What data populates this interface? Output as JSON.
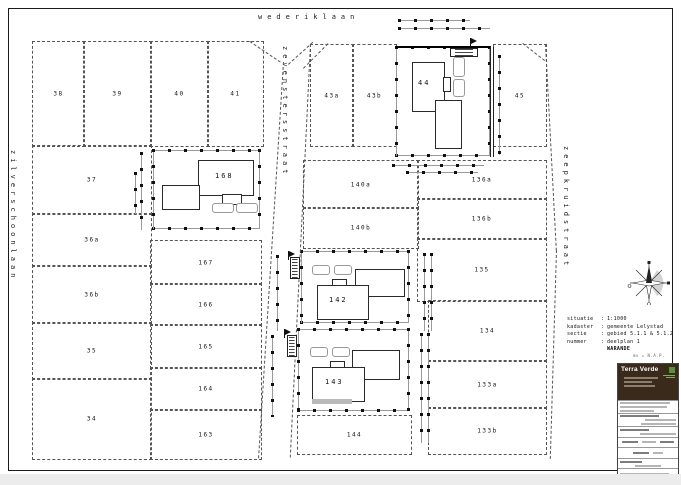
{
  "canvas": {
    "w": 681,
    "h": 485,
    "bg": "#ffffff",
    "line_color": "#333333",
    "accent_brown": "#3a2a1c",
    "accent_green": "#5a8f3c"
  },
  "streets": [
    {
      "name": "wederiklaan",
      "x": 258,
      "y": 13,
      "vertical": false
    },
    {
      "name": "zilverschoonlaan",
      "x": 9,
      "y": 150,
      "vertical": true
    },
    {
      "name": "zevenstersstraat",
      "x": 281,
      "y": 46,
      "vertical": true
    },
    {
      "name": "zeepkruidstraat",
      "x": 562,
      "y": 146,
      "vertical": true
    }
  ],
  "parcels": [
    {
      "label": "38",
      "x": 32,
      "y": 41,
      "w": 51,
      "h": 104
    },
    {
      "label": "39",
      "x": 83,
      "y": 41,
      "w": 67,
      "h": 104
    },
    {
      "label": "40",
      "x": 150,
      "y": 41,
      "w": 57,
      "h": 104
    },
    {
      "label": "41",
      "x": 207,
      "y": 41,
      "w": 55,
      "h": 104
    },
    {
      "label": "37",
      "x": 32,
      "y": 145,
      "w": 118,
      "h": 68
    },
    {
      "label": "36a",
      "x": 32,
      "y": 213,
      "w": 118,
      "h": 52
    },
    {
      "label": "36b",
      "x": 32,
      "y": 265,
      "w": 118,
      "h": 57
    },
    {
      "label": "35",
      "x": 32,
      "y": 322,
      "w": 118,
      "h": 56
    },
    {
      "label": "34",
      "x": 32,
      "y": 378,
      "w": 118,
      "h": 80
    },
    {
      "label": "167",
      "x": 150,
      "y": 240,
      "w": 110,
      "h": 43
    },
    {
      "label": "166",
      "x": 150,
      "y": 283,
      "w": 110,
      "h": 41
    },
    {
      "label": "165",
      "x": 150,
      "y": 324,
      "w": 110,
      "h": 43
    },
    {
      "label": "164",
      "x": 150,
      "y": 367,
      "w": 110,
      "h": 42
    },
    {
      "label": "163",
      "x": 150,
      "y": 409,
      "w": 110,
      "h": 49
    },
    {
      "label": "43a",
      "x": 310,
      "y": 44,
      "w": 42,
      "h": 101
    },
    {
      "label": "43b",
      "x": 352,
      "y": 44,
      "w": 43,
      "h": 101
    },
    {
      "label": "45",
      "x": 493,
      "y": 44,
      "w": 52,
      "h": 101
    },
    {
      "label": "140a",
      "x": 303,
      "y": 160,
      "w": 114,
      "h": 47
    },
    {
      "label": "140b",
      "x": 303,
      "y": 207,
      "w": 114,
      "h": 40
    },
    {
      "label": "136a",
      "x": 417,
      "y": 160,
      "w": 128,
      "h": 38
    },
    {
      "label": "136b",
      "x": 417,
      "y": 198,
      "w": 128,
      "h": 40
    },
    {
      "label": "135",
      "x": 417,
      "y": 238,
      "w": 128,
      "h": 62
    },
    {
      "label": "134",
      "x": 428,
      "y": 300,
      "w": 117,
      "h": 60
    },
    {
      "label": "133a",
      "x": 428,
      "y": 360,
      "w": 117,
      "h": 47
    },
    {
      "label": "133b",
      "x": 428,
      "y": 407,
      "w": 117,
      "h": 46
    },
    {
      "label": "144",
      "x": 297,
      "y": 415,
      "w": 113,
      "h": 38
    }
  ],
  "buildings": [
    {
      "label": "168",
      "lx": 215,
      "ly": 172,
      "rects": [
        [
          198,
          160,
          54,
          34
        ],
        [
          222,
          194,
          18,
          9
        ],
        [
          162,
          185,
          36,
          23
        ]
      ],
      "cars": [
        [
          212,
          203,
          20,
          8
        ],
        [
          236,
          203,
          20,
          8
        ]
      ]
    },
    {
      "label": "44",
      "lx": 418,
      "ly": 79,
      "rects": [
        [
          412,
          62,
          31,
          48
        ],
        [
          443,
          77,
          6,
          13
        ],
        [
          435,
          100,
          25,
          47
        ]
      ],
      "cars": [
        [
          453,
          57,
          10,
          18
        ],
        [
          453,
          79,
          10,
          16
        ]
      ]
    },
    {
      "label": "142",
      "lx": 329,
      "ly": 296,
      "rects": [
        [
          355,
          269,
          48,
          26
        ],
        [
          332,
          279,
          13,
          6
        ],
        [
          317,
          285,
          50,
          33
        ]
      ],
      "cars": [
        [
          312,
          265,
          16,
          8
        ],
        [
          334,
          265,
          16,
          8
        ]
      ]
    },
    {
      "label": "143",
      "lx": 325,
      "ly": 378,
      "rects": [
        [
          352,
          350,
          46,
          28
        ],
        [
          330,
          361,
          13,
          6
        ],
        [
          312,
          367,
          51,
          33
        ]
      ],
      "cars": [
        [
          310,
          347,
          16,
          8
        ],
        [
          332,
          347,
          16,
          8
        ]
      ]
    }
  ],
  "fences": [
    [
      152,
      149,
      108,
      80
    ],
    [
      395,
      46,
      95,
      110
    ],
    [
      300,
      250,
      109,
      73
    ],
    [
      297,
      328,
      112,
      83
    ]
  ],
  "dims": {
    "h": [
      [
        398,
        19,
        72
      ],
      [
        398,
        27,
        92
      ],
      [
        392,
        164,
        92
      ],
      [
        406,
        171,
        72
      ]
    ],
    "v": [
      [
        140,
        152,
        78
      ],
      [
        134,
        172,
        42
      ],
      [
        276,
        255,
        76
      ],
      [
        271,
        335,
        82
      ],
      [
        498,
        55,
        100
      ],
      [
        423,
        253,
        78
      ],
      [
        430,
        253,
        78
      ],
      [
        420,
        333,
        110
      ],
      [
        427,
        333,
        110
      ]
    ]
  },
  "solids": {
    "v": [
      [
        490,
        47,
        110
      ],
      [
        493,
        47,
        110
      ]
    ],
    "thick": [
      [
        395,
        46,
        95
      ]
    ]
  },
  "slants": [
    [
      283,
      62,
      397,
      3.6
    ],
    [
      310,
      44,
      414,
      2.8
    ],
    [
      545,
      44,
      207,
      -3
    ],
    [
      556,
      250,
      209,
      1.7
    ]
  ],
  "diags": [
    [
      250,
      41,
      37,
      34
    ],
    [
      288,
      64,
      33,
      -42
    ],
    [
      303,
      68,
      35,
      -45
    ],
    [
      523,
      43,
      28,
      38
    ]
  ],
  "flags": [
    [
      470,
      38
    ],
    [
      288,
      251
    ],
    [
      284,
      329
    ]
  ],
  "plates": [
    [
      450,
      48,
      26,
      7
    ],
    [
      290,
      257,
      8,
      20
    ],
    [
      287,
      335,
      8,
      20
    ]
  ],
  "graybars": [
    [
      312,
      399,
      40,
      5
    ]
  ],
  "annotation": {
    "rows": [
      {
        "label": "situatie",
        "value": "1:1000"
      },
      {
        "label": "kadaster",
        "value": "gemeente Lelystad"
      },
      {
        "label": "sectie",
        "value": "gebied 5.1.1 & 5.1.2"
      },
      {
        "label": "nummer",
        "value": "deelplan 1"
      }
    ],
    "project": "WARANDE"
  },
  "level_note": "mv = N.A.P.",
  "titleblock": {
    "company": "Terra Verde"
  }
}
